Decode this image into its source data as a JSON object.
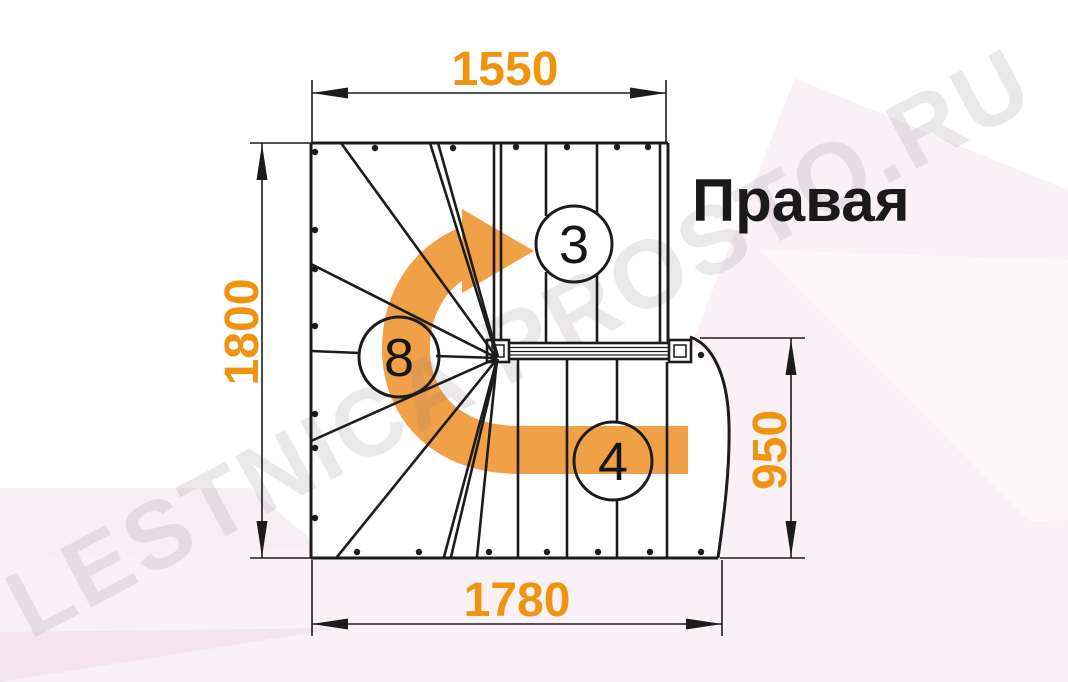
{
  "title": {
    "handedness_label": "Правая"
  },
  "watermark": {
    "text": "LESTNICA PROSTO.RU"
  },
  "dimensions": {
    "top_width": "1550",
    "left_height": "1800",
    "right_height": "950",
    "bottom_width": "1780"
  },
  "step_labels": {
    "upper_flight_steps": "3",
    "winder_steps": "8",
    "lower_flight_steps": "4"
  },
  "colors": {
    "dimension_text": "#F0930F",
    "direction_arrow": "#F0A148",
    "linework": "#1C1C1C",
    "label_text": "#151515"
  }
}
